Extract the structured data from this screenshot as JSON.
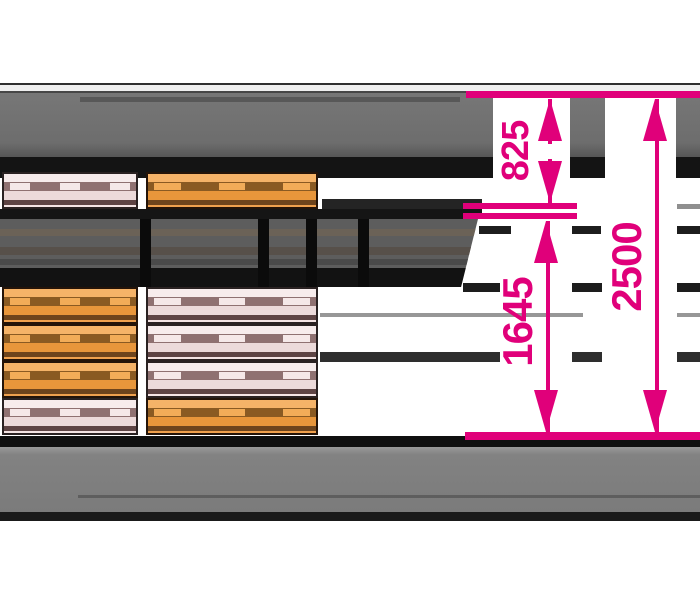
{
  "dimensions": {
    "top_to_shelf": {
      "label": "825"
    },
    "shelf_to_floor": {
      "label": "1645"
    },
    "total_height": {
      "label": "2500"
    }
  },
  "colors": {
    "dimension": "#E0007A",
    "pallet_orange": "#F0A14E",
    "pallet_pink": "#F4E4E4",
    "structure_gray": "#6F6F6F",
    "structure_black": "#151515",
    "floor_gray": "#7E7E7E"
  },
  "cargo": {
    "upper_deck": [
      "pink",
      "orange"
    ],
    "lower_deck_left_stack": [
      "orange",
      "orange",
      "orange",
      "pink"
    ],
    "lower_deck_right_stack": [
      "pink",
      "pink",
      "pink",
      "orange"
    ]
  }
}
